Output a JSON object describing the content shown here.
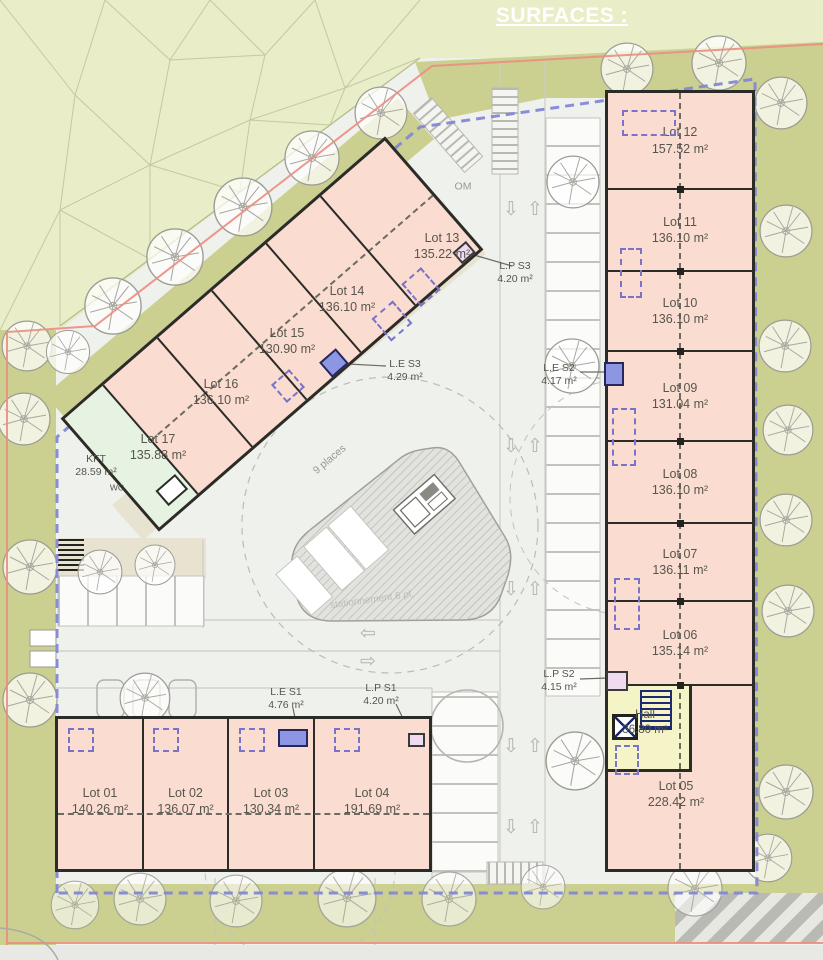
{
  "title": "SURFACES :",
  "right_building": {
    "lots": [
      {
        "name": "Lot 12",
        "area": "157.52 m²"
      },
      {
        "name": "Lot 11",
        "area": "136.10 m²"
      },
      {
        "name": "Lot 10",
        "area": "136.10 m²"
      },
      {
        "name": "Lot 09",
        "area": "131.04 m²"
      },
      {
        "name": "Lot 08",
        "area": "136.10 m²"
      },
      {
        "name": "Lot 07",
        "area": "136.11 m²"
      },
      {
        "name": "Lot 06",
        "area": "135.14 m²"
      },
      {
        "name": "Lot 05",
        "area": "228.42 m²"
      }
    ],
    "hall": {
      "name": "Hall",
      "area": "36.80 m²"
    }
  },
  "diagonal_building": {
    "lots": [
      {
        "name": "Lot 13",
        "area": "135.22 m²"
      },
      {
        "name": "Lot 14",
        "area": "136.10 m²"
      },
      {
        "name": "Lot 15",
        "area": "130.90 m²"
      },
      {
        "name": "Lot 16",
        "area": "136.10 m²"
      },
      {
        "name": "Lot 17",
        "area": "135.88 m²"
      }
    ],
    "kft": {
      "name": "KFT",
      "area": "28.59 m²"
    },
    "wc": "WC"
  },
  "bottom_building": {
    "lots": [
      {
        "name": "Lot 01",
        "area": "140.26 m²"
      },
      {
        "name": "Lot 02",
        "area": "136.07 m²"
      },
      {
        "name": "Lot 03",
        "area": "130.34 m²"
      },
      {
        "name": "Lot 04",
        "area": "191.69 m²"
      }
    ]
  },
  "service_rooms": [
    {
      "name": "L.P S3",
      "area": "4.20 m²"
    },
    {
      "name": "L.E S3",
      "area": "4.29 m²"
    },
    {
      "name": "L.E S2",
      "area": "4.17 m²"
    },
    {
      "name": "L.P S2",
      "area": "4.15 m²"
    },
    {
      "name": "L.E S1",
      "area": "4.76 m²"
    },
    {
      "name": "L.P S1",
      "area": "4.20 m²"
    }
  ],
  "site_labels": {
    "om": "OM",
    "places": "9 places",
    "parking_note": "stationnement 6 pl."
  },
  "icons": {
    "arrow_up": "⇧",
    "arrow_down": "⇩",
    "arrow_left": "⇦",
    "arrow_right": "⇨"
  },
  "colors": {
    "building_fill": "#fadcd0",
    "building_stroke": "#2b2b27",
    "boundary_dashed_blue": "#8287d6",
    "boundary_red": "#ec8d80",
    "hall_fill": "#f4f4c6",
    "kft_fill": "#e6f2e2",
    "le_square_blue": "#8d96e2",
    "lp_square_pink": "#efdaf0",
    "olive_green": "#cbcf90",
    "mesh_green": "#e9edc8",
    "road": "#eff1ed",
    "label_text": "#56564e"
  }
}
